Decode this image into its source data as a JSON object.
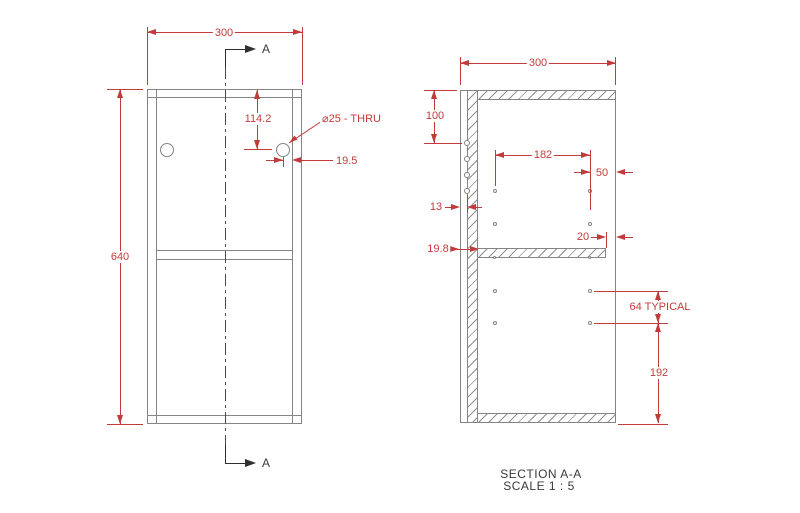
{
  "front_view": {
    "width_dim": "300",
    "height_dim": "640",
    "hole_offset_dim": "114.2",
    "hole_callout": "⌀25 - THRU",
    "hole_edge_dim": "19.5",
    "section_label": "A"
  },
  "section_view": {
    "width_dim": "300",
    "top_hole_dim": "100",
    "hole_spacing_dim": "182",
    "right_edge_dim": "50",
    "back_panel_dim": "13",
    "shelf_setback_dim": "20",
    "shelf_thickness_dim": "19.8",
    "hole_pitch_dim": "64 TYPICAL",
    "lower_span_dim": "192",
    "caption_title": "SECTION A-A",
    "caption_scale": "SCALE 1 : 5"
  },
  "colors": {
    "dimension_red": "#c23b3b",
    "geometry_gray": "#848484",
    "annotation_dark": "#3a3a3a"
  }
}
